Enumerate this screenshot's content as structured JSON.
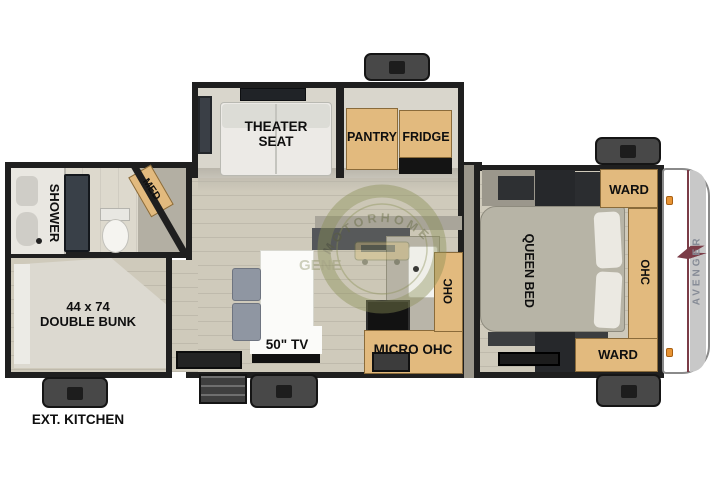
{
  "title": "travel trailer floor plan",
  "labels": {
    "theater_seat": "THEATER SEAT",
    "pantry": "PANTRY",
    "fridge": "FRIDGE",
    "med": "MED",
    "shower": "SHOWER",
    "bunk_size": "44 x 74",
    "bunk_name": "DOUBLE BUNK",
    "tv": "50\" TV",
    "micro_ohc": "MICRO OHC",
    "kitchen_ohc": "OHC",
    "queen_bed": "QUEEN BED",
    "ward_top": "WARD",
    "ward_bottom": "WARD",
    "bedroom_ohc": "OHC",
    "ext_kitchen": "EXT. KITCHEN",
    "brand": "AVENGER"
  },
  "watermark": {
    "arc_text": "MOTORHOME",
    "fragment": "GENE"
  },
  "colors": {
    "wall": "#1f1f1f",
    "floor_wood": "#cfcabb",
    "floor_slide": "#d9d6cc",
    "cabinet_tan": "#e2ba7e",
    "exterior_box": "#484848",
    "accent_maroon": "#7b3c47",
    "marker_light_orange": "#e89434",
    "watermark_olive": "#8a8f55",
    "brand_text_gray": "#868b96"
  }
}
